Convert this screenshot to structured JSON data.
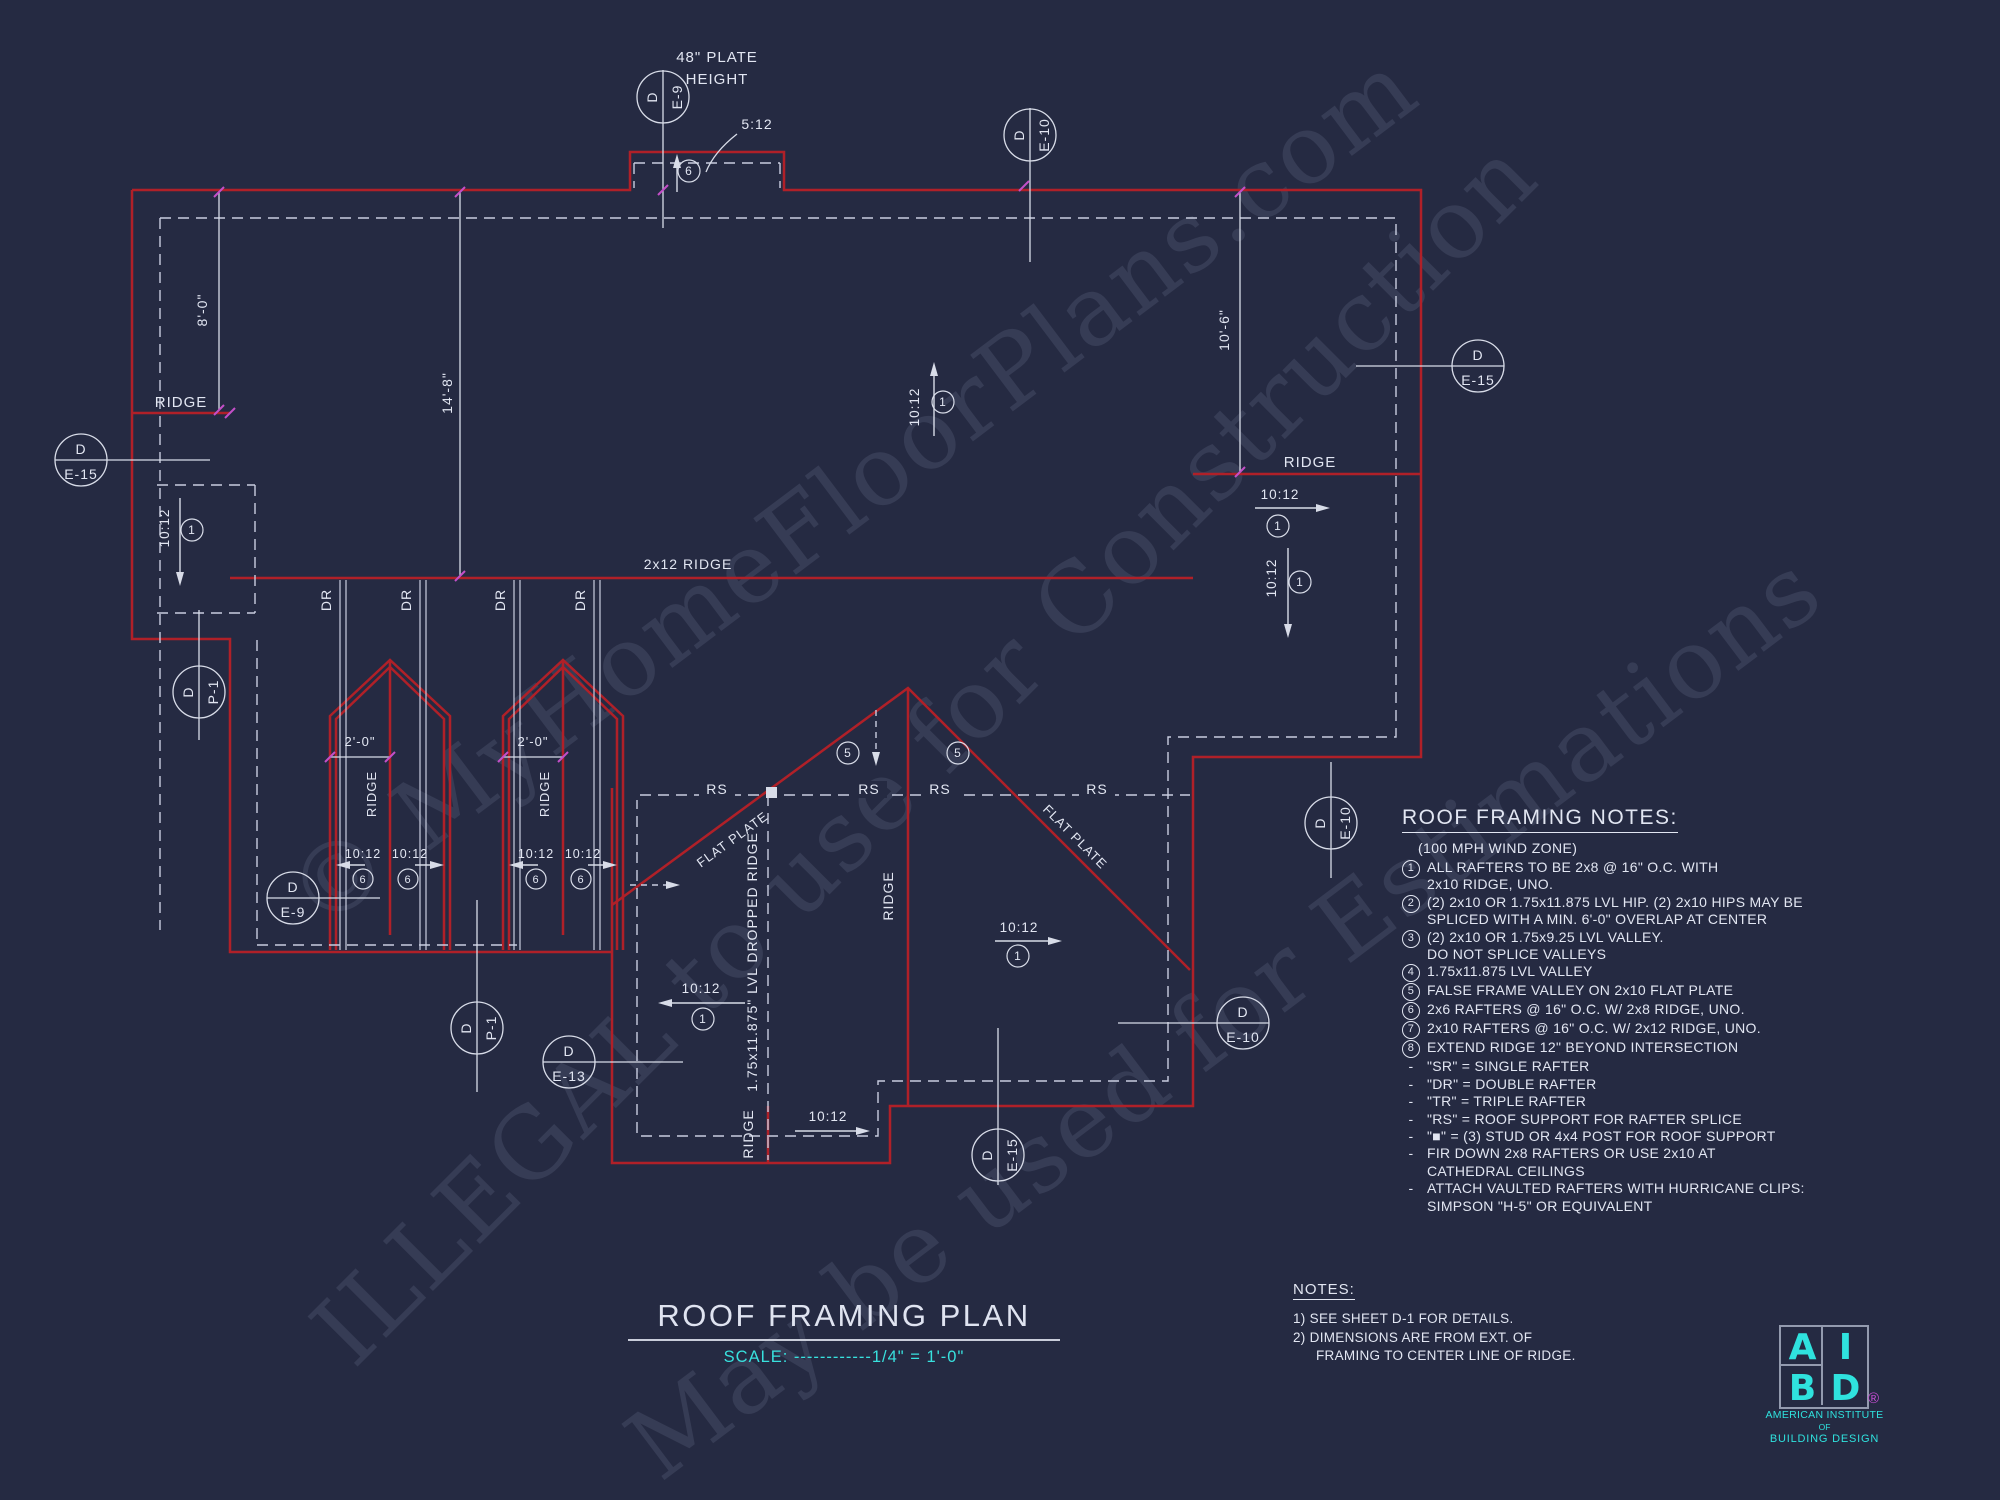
{
  "sheet": {
    "title": "ROOF FRAMING PLAN",
    "scale": "SCALE: ------------1/4\" = 1'-0\""
  },
  "colors": {
    "background": "#252a42",
    "roof_outline_red": "#b02028",
    "drafting_white": "#d8dce8",
    "accent_cyan": "#38e1de",
    "tick_magenta": "#c44fc8"
  },
  "labels": {
    "ridge": "RIDGE",
    "ridge_2x12": "2x12 RIDGE",
    "dropped_ridge": "1.75x11.875\" LVL DROPPED RIDGE",
    "flat_plate": "FLAT PLATE",
    "double_rafter": "DR",
    "roof_support": "RS",
    "pitch_10": "10:12",
    "pitch_5": "5:12",
    "plate_height_line1": "48\" PLATE",
    "plate_height_line2": "HEIGHT"
  },
  "dimensions": {
    "d_8_0": "8'-0\"",
    "d_14_8": "14'-8\"",
    "d_10_6": "10'-6\"",
    "d_2_0": "2'-0\""
  },
  "callouts": {
    "detail": "D",
    "e9": "E-9",
    "e10": "E-10",
    "e13": "E-13",
    "e15": "E-15",
    "p1": "P-1"
  },
  "markers": {
    "n1": "1",
    "n5": "5",
    "n6": "6"
  },
  "framing_notes": {
    "title": "ROOF FRAMING NOTES:",
    "subtitle": "(100 MPH WIND ZONE)",
    "items": [
      {
        "marker": "1",
        "lines": [
          "ALL RAFTERS TO BE 2x8 @ 16\" O.C. WITH",
          "2x10 RIDGE, UNO."
        ]
      },
      {
        "marker": "2",
        "lines": [
          "(2) 2x10 OR 1.75x11.875 LVL HIP. (2) 2x10 HIPS MAY BE",
          "SPLICED WITH A MIN. 6'-0\" OVERLAP AT CENTER"
        ]
      },
      {
        "marker": "3",
        "lines": [
          "(2) 2x10 OR 1.75x9.25 LVL VALLEY.",
          "DO NOT SPLICE VALLEYS"
        ]
      },
      {
        "marker": "4",
        "lines": [
          "1.75x11.875 LVL VALLEY"
        ]
      },
      {
        "marker": "5",
        "lines": [
          "FALSE FRAME VALLEY ON 2x10 FLAT PLATE"
        ]
      },
      {
        "marker": "6",
        "lines": [
          "2x6 RAFTERS @ 16\" O.C. W/ 2x8 RIDGE, UNO."
        ]
      },
      {
        "marker": "7",
        "lines": [
          "2x10 RAFTERS @ 16\" O.C. W/ 2x12 RIDGE, UNO."
        ]
      },
      {
        "marker": "8",
        "lines": [
          "EXTEND RIDGE 12\" BEYOND INTERSECTION"
        ]
      },
      {
        "marker": "-",
        "lines": [
          "\"SR\" = SINGLE RAFTER"
        ]
      },
      {
        "marker": "-",
        "lines": [
          "\"DR\" = DOUBLE RAFTER"
        ]
      },
      {
        "marker": "-",
        "lines": [
          "\"TR\" = TRIPLE RAFTER"
        ]
      },
      {
        "marker": "-",
        "lines": [
          "\"RS\" = ROOF SUPPORT FOR RAFTER SPLICE"
        ]
      },
      {
        "marker": "-",
        "lines": [
          "\"■\"  = (3) STUD OR 4x4 POST FOR ROOF SUPPORT"
        ]
      },
      {
        "marker": "-",
        "lines": [
          "FIR DOWN 2x8 RAFTERS OR USE 2x10 AT",
          "CATHEDRAL CEILINGS"
        ]
      },
      {
        "marker": "-",
        "lines": [
          "ATTACH VAULTED RAFTERS WITH HURRICANE CLIPS:",
          "SIMPSON \"H-5\" OR EQUIVALENT"
        ]
      }
    ]
  },
  "general_notes": {
    "title": "NOTES:",
    "n1": "1)  SEE SHEET D-1 FOR DETAILS.",
    "n2a": "2)  DIMENSIONS ARE FROM EXT. OF",
    "n2b": "FRAMING TO CENTER LINE OF RIDGE."
  },
  "watermarks": {
    "w1": "© MyHomeFloorPlans.com",
    "w2": "ILLEGAL to use for Construction",
    "w3": "May be used for Estimations"
  },
  "logo": {
    "l_a": "A",
    "l_i": "I",
    "l_b": "B",
    "l_d": "D",
    "reg": "®",
    "line1": "AMERICAN INSTITUTE",
    "line2": "OF",
    "line3": "BUILDING DESIGN"
  }
}
